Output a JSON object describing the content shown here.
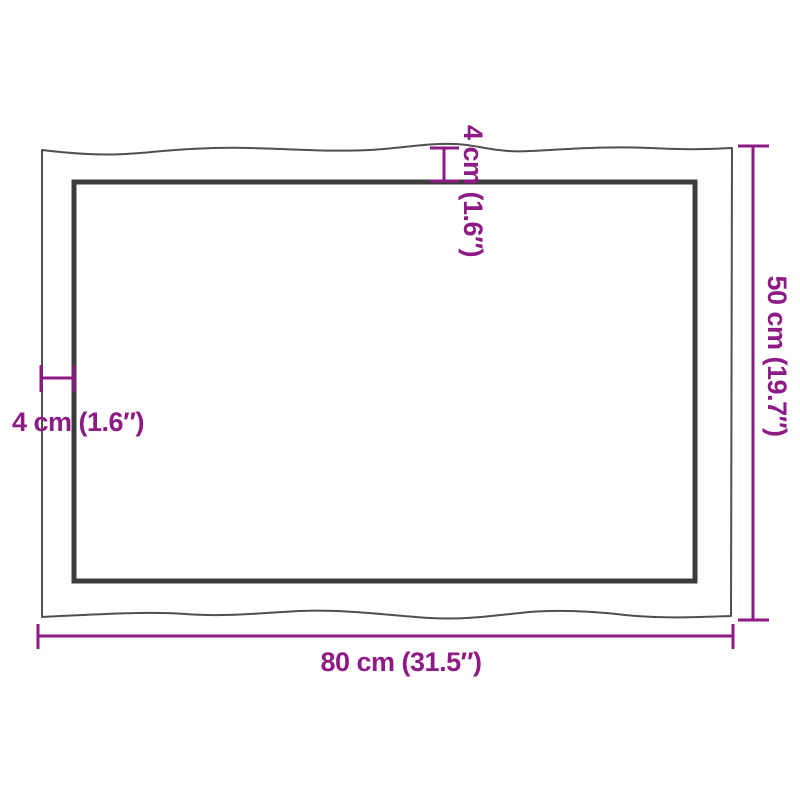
{
  "colors": {
    "accent": "#8E1A85",
    "outline": "#3C3C3C",
    "outline-thin": "#4F4F4F",
    "background": "#FFFFFF"
  },
  "diagram": {
    "subject": "tabletop-live-edge-dimension-diagram",
    "labels": {
      "width": "80 cm (31.5″)",
      "height": "50 cm (19.7″)",
      "thickness_top": "4 cm (1.6″)",
      "thickness_left": "4 cm (1.6″)"
    }
  }
}
